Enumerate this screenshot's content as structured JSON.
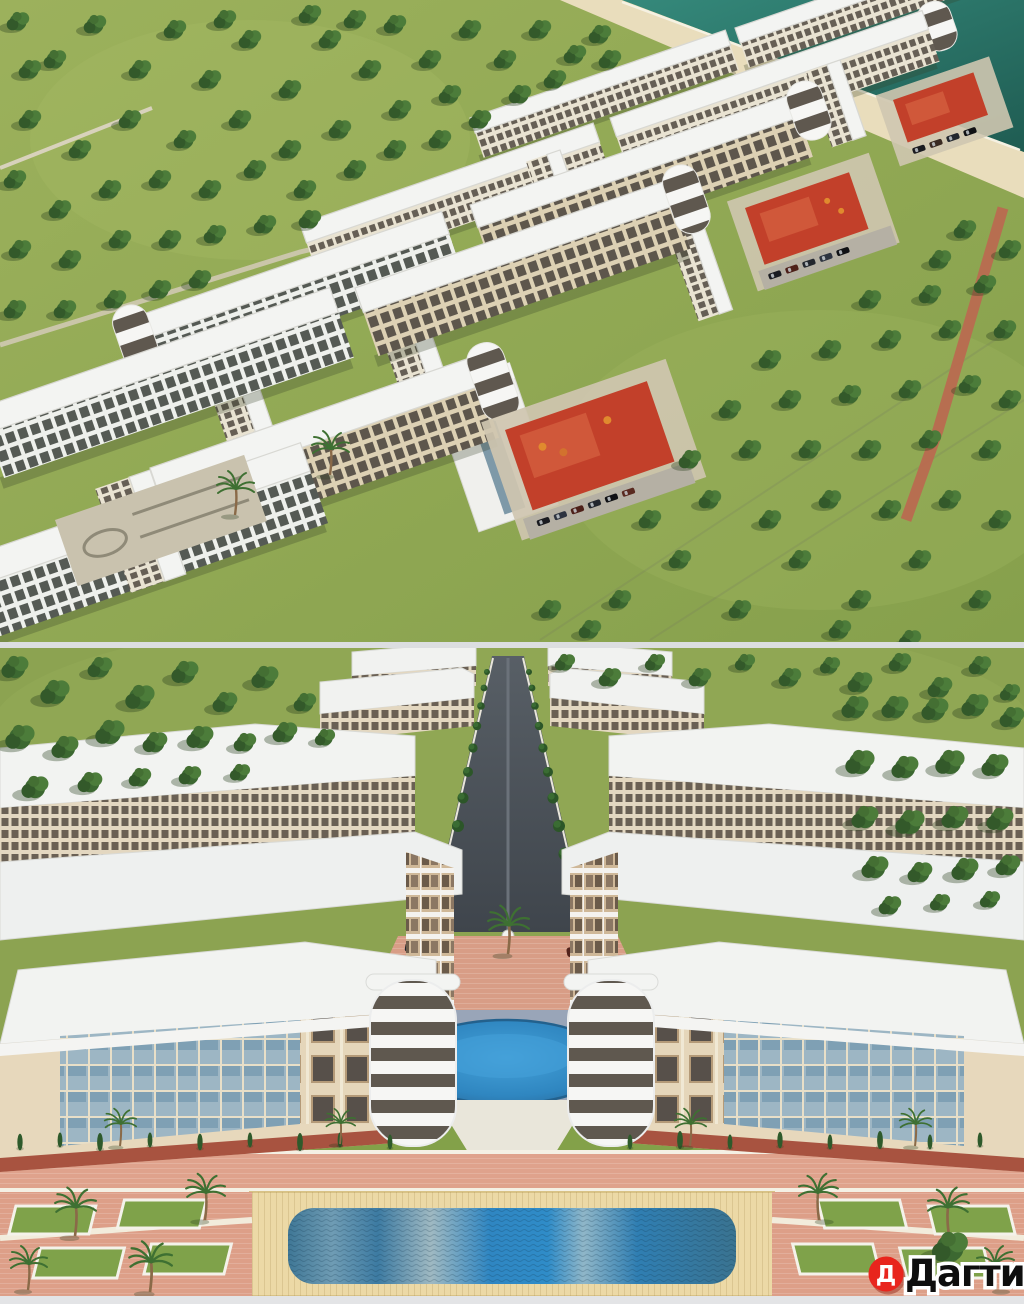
{
  "watermark": {
    "logo_letter": "Д",
    "brand": "Дагти",
    "logo_bg": "#e8251d",
    "logo_fg": "#ffffff",
    "text_color": "#0e0e0e",
    "text_outline": "#ffffff"
  },
  "palette": {
    "sea_water": "#2f8274",
    "beach_sand": "#e9ddbc",
    "grass": "#93aa55",
    "tree_green": "#3c6831",
    "roof_white": "#f3f4f2",
    "facade_tan": "#ddd1b4",
    "window_dark": "#575b54",
    "courtyard_red": "#c2402a",
    "plaza_salmon": "#dd9f88",
    "paving_blue_gray": "#99a5b8",
    "pool_blue": "#2f8cc8",
    "deck_cream": "#ecd9a6",
    "alley_asphalt": "#4b5157"
  }
}
